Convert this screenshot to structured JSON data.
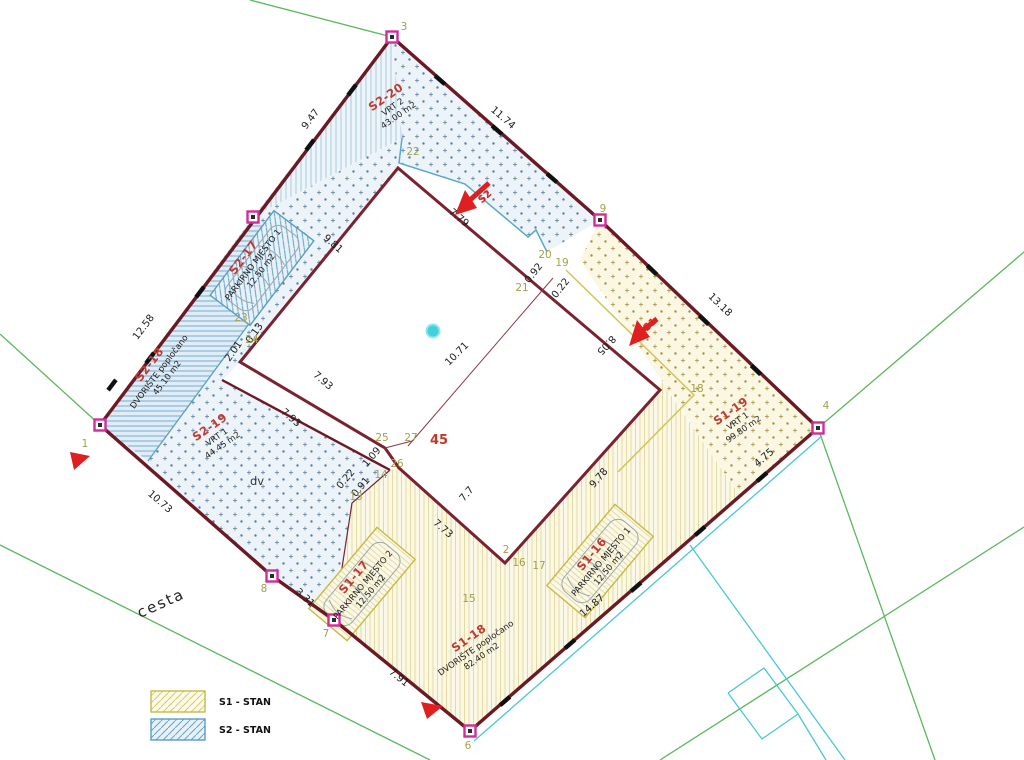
{
  "colors": {
    "boundary": "#6b1a24",
    "building_outline": "#7a2230",
    "s1_accent": "#c9b945",
    "s2_accent": "#5a9ec4",
    "zone_code_red": "#bf3b33",
    "marker_magenta": "#d02d97",
    "vertex_olive": "#a2a24c",
    "arrow_red": "#e02020",
    "road_green": "#5cb85c",
    "cyan": "#49c8d8"
  },
  "legend": {
    "items": [
      {
        "label": "S1 - STAN",
        "swatch": "yellow-diagonal-hatch"
      },
      {
        "label": "S2 - STAN",
        "swatch": "blue-diagonal-hatch"
      }
    ]
  },
  "misc": {
    "road": "cesta",
    "dv": "dv",
    "building_number": "45"
  },
  "arrows": {
    "s2": {
      "label": "S2"
    },
    "s1": {
      "label": "S1"
    }
  },
  "zones": [
    {
      "id": "s2-20",
      "code": "S2-20",
      "lines": [
        "VRT 2",
        "43.00 m2"
      ],
      "x": 392,
      "y": 106,
      "r": -35
    },
    {
      "id": "s2-17",
      "code": "S2-17",
      "lines": [
        "PARKIRNO MJESTO 1",
        "12.50 m2"
      ],
      "x": 252,
      "y": 264,
      "r": -53
    },
    {
      "id": "s2-18",
      "code": "S2-18",
      "lines": [
        "DVORIŠTE popločano",
        "45.10 m2"
      ],
      "x": 158,
      "y": 371,
      "r": -53
    },
    {
      "id": "s2-19",
      "code": "S2-19",
      "lines": [
        "VRT 1",
        "44.45 m2"
      ],
      "x": 216,
      "y": 436,
      "r": -35
    },
    {
      "id": "s1-17",
      "code": "S1-17",
      "lines": [
        "PARKIRNO MJESTO 2",
        "12.50 m2"
      ],
      "x": 362,
      "y": 584,
      "r": -50
    },
    {
      "id": "s1-18",
      "code": "S1-18",
      "lines": [
        "DVORIŠTE popločano",
        "82.40 m2"
      ],
      "x": 475,
      "y": 647,
      "r": -35
    },
    {
      "id": "s1-16",
      "code": "S1-16",
      "lines": [
        "PARKIRNO MJESTO 1",
        "12.50 m2"
      ],
      "x": 600,
      "y": 561,
      "r": -50
    },
    {
      "id": "s1-19",
      "code": "S1-19",
      "lines": [
        "VRT 1",
        "99.80 m2"
      ],
      "x": 737,
      "y": 420,
      "r": -35
    }
  ],
  "dimensions": [
    {
      "t": "9.47",
      "x": 313,
      "y": 121,
      "r": -53
    },
    {
      "t": "11.74",
      "x": 501,
      "y": 120,
      "r": 41
    },
    {
      "t": "13.18",
      "x": 718,
      "y": 307,
      "r": 44
    },
    {
      "t": "12.58",
      "x": 146,
      "y": 329,
      "r": -53
    },
    {
      "t": "10.73",
      "x": 158,
      "y": 504,
      "r": 41
    },
    {
      "t": "3.31",
      "x": 303,
      "y": 600,
      "r": 42
    },
    {
      "t": "7.91",
      "x": 397,
      "y": 680,
      "r": 39
    },
    {
      "t": "14.87",
      "x": 594,
      "y": 608,
      "r": -41
    },
    {
      "t": "4.75",
      "x": 766,
      "y": 460,
      "r": -41
    },
    {
      "t": "7.79",
      "x": 457,
      "y": 220,
      "r": 40
    },
    {
      "t": "9.81",
      "x": 331,
      "y": 246,
      "r": 41
    },
    {
      "t": "2.01",
      "x": 236,
      "y": 353,
      "r": -55
    },
    {
      "t": "0.13",
      "x": 257,
      "y": 335,
      "r": -55
    },
    {
      "t": "7.93",
      "x": 321,
      "y": 383,
      "r": 41
    },
    {
      "t": "7.93",
      "x": 289,
      "y": 420,
      "r": 41
    },
    {
      "t": "10.71",
      "x": 459,
      "y": 356,
      "r": -45
    },
    {
      "t": "8.05",
      "x": 604,
      "y": 343,
      "r": 133
    },
    {
      "t": "9.78",
      "x": 601,
      "y": 480,
      "r": -49
    },
    {
      "t": "7.7",
      "x": 469,
      "y": 496,
      "r": -49
    },
    {
      "t": "7.73",
      "x": 441,
      "y": 531,
      "r": 41
    },
    {
      "t": "1.09",
      "x": 374,
      "y": 459,
      "r": -50
    },
    {
      "t": "0.91",
      "x": 363,
      "y": 489,
      "r": -50
    },
    {
      "t": "0.22",
      "x": 348,
      "y": 481,
      "r": -50
    },
    {
      "t": "0.92",
      "x": 536,
      "y": 275,
      "r": -52
    },
    {
      "t": "0.22",
      "x": 563,
      "y": 290,
      "r": -52
    }
  ],
  "vertices": [
    {
      "n": "1",
      "x": 85,
      "y": 447
    },
    {
      "n": "2",
      "x": 506,
      "y": 553
    },
    {
      "n": "3",
      "x": 404,
      "y": 30
    },
    {
      "n": "4",
      "x": 826,
      "y": 409
    },
    {
      "n": "6",
      "x": 468,
      "y": 749
    },
    {
      "n": "7",
      "x": 326,
      "y": 637
    },
    {
      "n": "8",
      "x": 264,
      "y": 592
    },
    {
      "n": "9",
      "x": 603,
      "y": 212
    },
    {
      "n": "13",
      "x": 356,
      "y": 500
    },
    {
      "n": "14",
      "x": 381,
      "y": 478
    },
    {
      "n": "15",
      "x": 469,
      "y": 602
    },
    {
      "n": "16",
      "x": 519,
      "y": 566
    },
    {
      "n": "17",
      "x": 539,
      "y": 569
    },
    {
      "n": "18",
      "x": 697,
      "y": 392
    },
    {
      "n": "19",
      "x": 562,
      "y": 266
    },
    {
      "n": "20",
      "x": 545,
      "y": 258
    },
    {
      "n": "21",
      "x": 522,
      "y": 291
    },
    {
      "n": "22",
      "x": 413,
      "y": 155
    },
    {
      "n": "23",
      "x": 241,
      "y": 321
    },
    {
      "n": "24",
      "x": 252,
      "y": 343
    },
    {
      "n": "25",
      "x": 382,
      "y": 441
    },
    {
      "n": "26",
      "x": 397,
      "y": 467
    },
    {
      "n": "27",
      "x": 411,
      "y": 441
    }
  ],
  "markers": [
    {
      "x": 100,
      "y": 425
    },
    {
      "x": 253,
      "y": 217
    },
    {
      "x": 392,
      "y": 37
    },
    {
      "x": 600,
      "y": 220
    },
    {
      "x": 818,
      "y": 428
    },
    {
      "x": 470,
      "y": 731
    },
    {
      "x": 334,
      "y": 620
    },
    {
      "x": 272,
      "y": 576
    }
  ],
  "ticks": [
    {
      "x": 150,
      "y": 358,
      "a": -53
    },
    {
      "x": 200,
      "y": 292,
      "a": -53
    },
    {
      "x": 310,
      "y": 145,
      "a": -53
    },
    {
      "x": 352,
      "y": 90,
      "a": -53
    },
    {
      "x": 440,
      "y": 80,
      "a": 41
    },
    {
      "x": 497,
      "y": 130,
      "a": 41
    },
    {
      "x": 552,
      "y": 178,
      "a": 41
    },
    {
      "x": 652,
      "y": 270,
      "a": 44
    },
    {
      "x": 704,
      "y": 320,
      "a": 44
    },
    {
      "x": 756,
      "y": 370,
      "a": 44
    },
    {
      "x": 762,
      "y": 477,
      "a": -41
    },
    {
      "x": 700,
      "y": 531,
      "a": -41
    },
    {
      "x": 636,
      "y": 587,
      "a": -41
    },
    {
      "x": 570,
      "y": 644,
      "a": -41
    },
    {
      "x": 505,
      "y": 701,
      "a": -41
    },
    {
      "x": 112,
      "y": 385,
      "a": -53
    }
  ]
}
